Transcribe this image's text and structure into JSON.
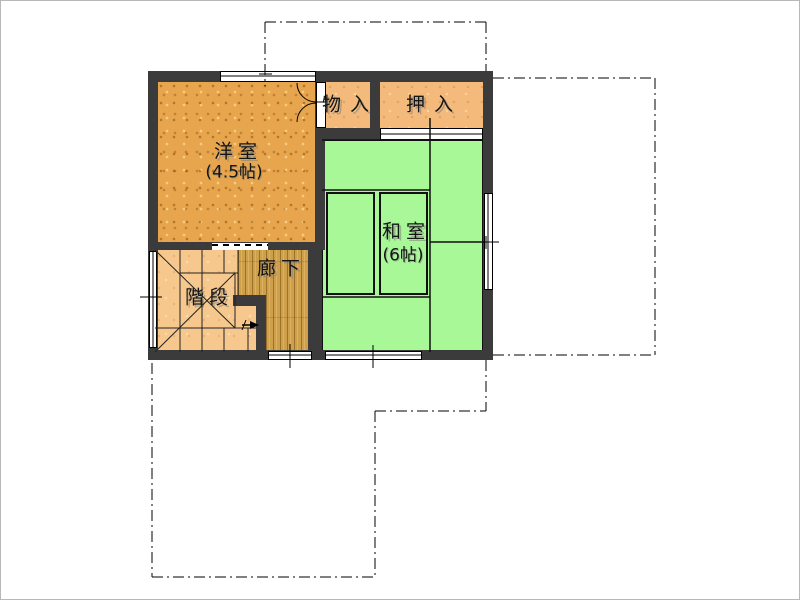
{
  "plan": {
    "type": "floor-plan",
    "rooms": {
      "western": {
        "name": "洋室",
        "size": "(4.5帖)"
      },
      "japanese": {
        "name": "和室",
        "size": "(6帖)"
      },
      "storage": {
        "name": "物入"
      },
      "closet": {
        "name": "押入"
      },
      "hallway": {
        "name": "廊下"
      },
      "stairs": {
        "name": "階段"
      }
    },
    "annotations": {
      "stair_direction_arrow": "right",
      "dashdot_outline_meaning": "adjacent-floor outline"
    },
    "colors": {
      "wall": "#3b3b3b",
      "western_floor": "#e7a64e",
      "closet_floor": "#f4ba7b",
      "stairs_floor": "#f7c88e",
      "tatami": "#a9f898",
      "hallway_floor": "#cfa04c",
      "line": "#000000",
      "background": "#ffffff"
    }
  }
}
